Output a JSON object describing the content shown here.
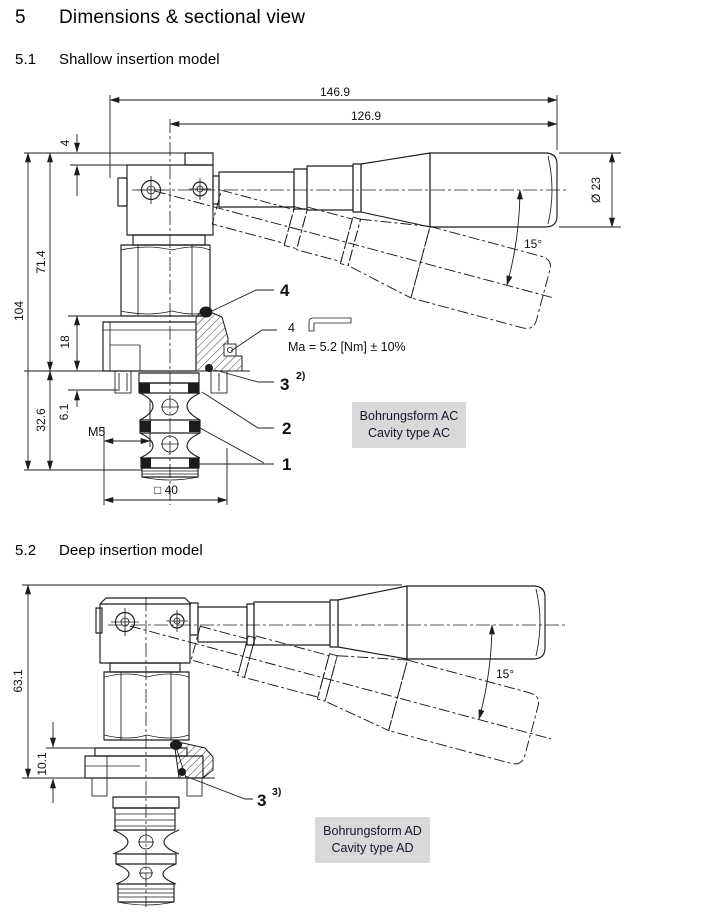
{
  "page": {
    "heading": {
      "number": "5",
      "title": "Dimensions & sectional view"
    },
    "sections": [
      {
        "number": "5.1",
        "title": "Shallow insertion model"
      },
      {
        "number": "5.2",
        "title": "Deep insertion model"
      }
    ]
  },
  "shallow": {
    "dimensions": {
      "overall_length": "146.9",
      "lever_length": "126.9",
      "top_step": "4",
      "overall_height": "104",
      "body_height": "71.4",
      "flange_height": "18",
      "insertion_depth": "32.6",
      "port_offset": "6.1",
      "thread": "M5",
      "square_flange": "□ 40",
      "lever_diameter": "Ø 23",
      "lever_angle": "15°"
    },
    "callouts": {
      "item_4": "4",
      "wrench_size": "4",
      "torque": "Ma = 5.2 [Nm] ± 10%",
      "item_3": "3",
      "item_3_note": "2)",
      "item_2": "2",
      "item_1": "1"
    },
    "cavity_box": {
      "line1": "Bohrungsform AC",
      "line2": "Cavity type AC"
    }
  },
  "deep": {
    "dimensions": {
      "overall_height": "63.1",
      "flange_height": "10.1",
      "lever_angle": "15°"
    },
    "callouts": {
      "item_3": "3",
      "item_3_note": "3)"
    },
    "cavity_box": {
      "line1": "Bohrungsform AD",
      "line2": "Cavity type AD"
    }
  }
}
